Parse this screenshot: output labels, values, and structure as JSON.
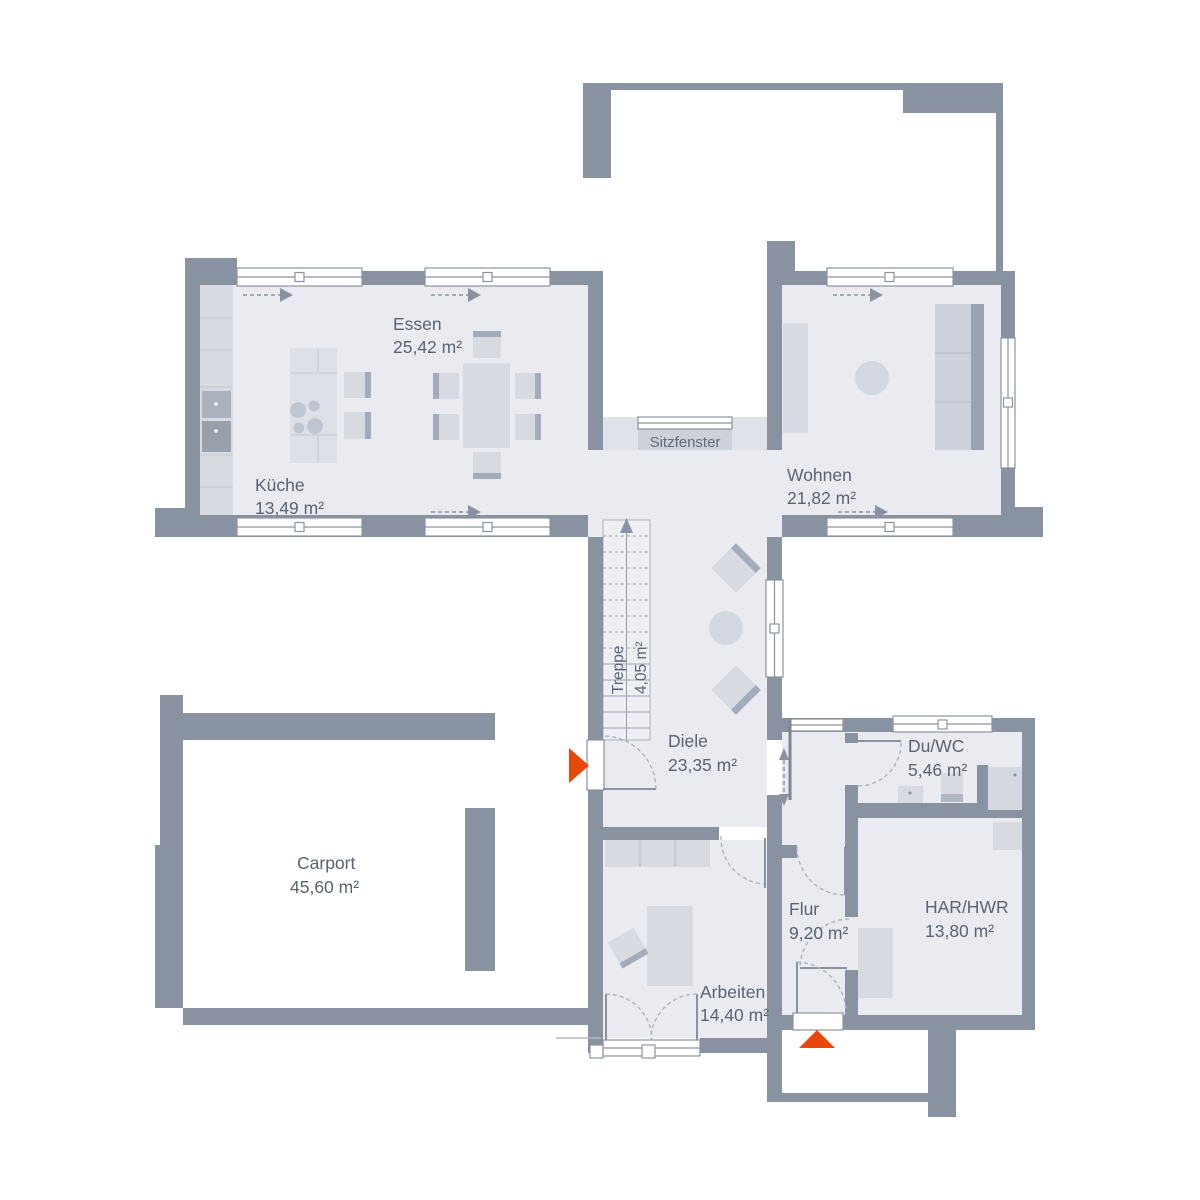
{
  "canvas": {
    "width": 1200,
    "height": 1200,
    "background": "#ffffff"
  },
  "palette": {
    "wall": "#8992a0",
    "floor": "#e9ebf0",
    "furniture": "#d7dae1",
    "furniture_dark": "#a4abba",
    "window_fill": "#ffffff",
    "text": "#5b6270",
    "entrance_marker": "#e8470e"
  },
  "rooms": [
    {
      "id": "essen",
      "label": "Essen",
      "area": "25,42 m²"
    },
    {
      "id": "kueche",
      "label": "Küche",
      "area": "13,49 m²"
    },
    {
      "id": "wohnen",
      "label": "Wohnen",
      "area": "21,82 m²"
    },
    {
      "id": "sitzfenster",
      "label": "Sitzfenster",
      "area": ""
    },
    {
      "id": "treppe",
      "label": "Treppe",
      "area": "4,05 m²"
    },
    {
      "id": "diele",
      "label": "Diele",
      "area": "23,35 m²"
    },
    {
      "id": "duwc",
      "label": "Du/WC",
      "area": "5,46 m²"
    },
    {
      "id": "carport",
      "label": "Carport",
      "area": "45,60 m²"
    },
    {
      "id": "flur",
      "label": "Flur",
      "area": "9,20 m²"
    },
    {
      "id": "harhwr",
      "label": "HAR/HWR",
      "area": "13,80 m²"
    },
    {
      "id": "arbeiten",
      "label": "Arbeiten",
      "area": "14,40 m²"
    }
  ],
  "symbols": {
    "entrance_markers": [
      "west-main-entrance",
      "south-secondary-entrance"
    ],
    "stair_direction": "up"
  }
}
